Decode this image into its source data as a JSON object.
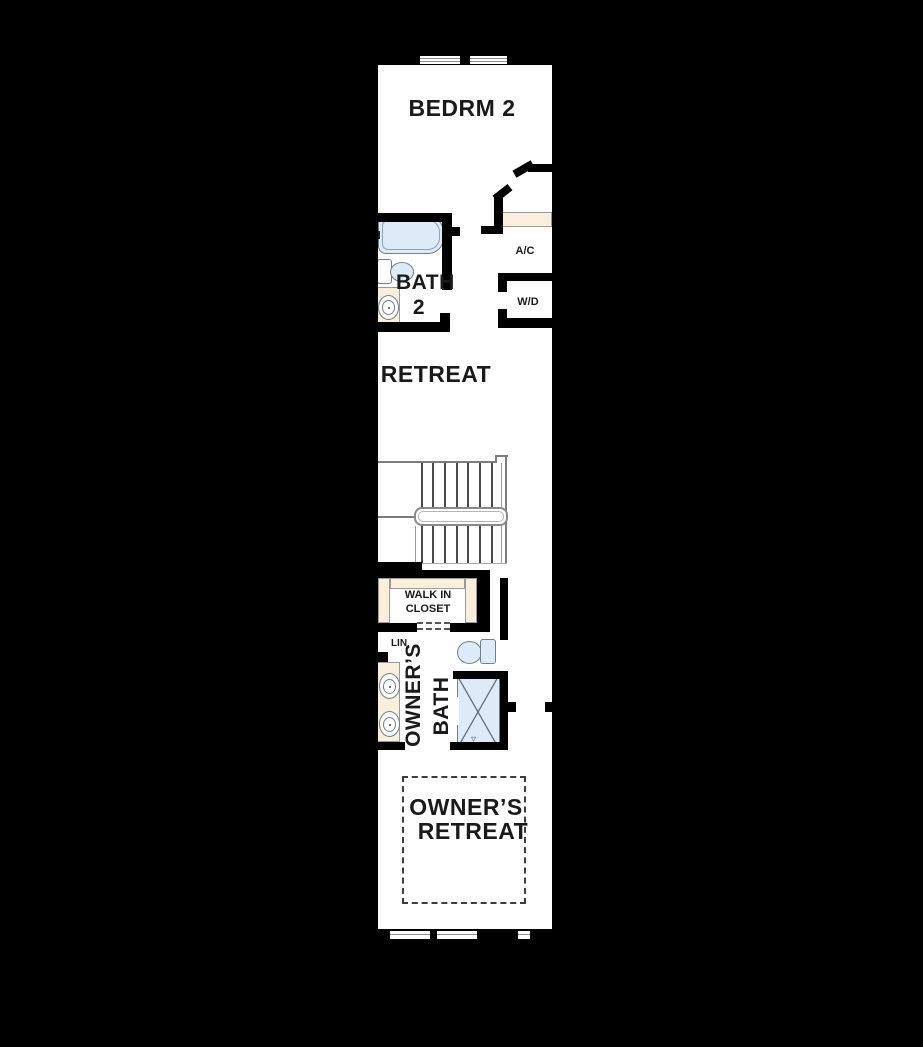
{
  "figure_type": "second-floor residential floor plan",
  "colors": {
    "background": "#000000",
    "floor": "#ffffff",
    "wall": "#000000",
    "fixture": "#dcebf7",
    "casework": "#f9efdb",
    "stair_line": "#7d7d7d",
    "text": "#1a1a1a"
  },
  "rooms": {
    "bedroom2": {
      "label": "BEDRM 2"
    },
    "bath2": {
      "label_line1": "BATH",
      "label_line2": "2"
    },
    "ac_closet": {
      "label": "A/C"
    },
    "laundry_closet": {
      "label": "W/D"
    },
    "retreat": {
      "label": "RETREAT"
    },
    "walk_in_closet": {
      "label_line1": "WALK IN",
      "label_line2": "CLOSET"
    },
    "linen_closet": {
      "label": "LIN"
    },
    "owners_bath": {
      "label_word1": "OWNER’S",
      "label_word2": "BATH"
    },
    "owners_retreat": {
      "label_line1": "OWNER’S",
      "label_line2": "RETREAT"
    }
  },
  "shower_drain_mark": "▿"
}
